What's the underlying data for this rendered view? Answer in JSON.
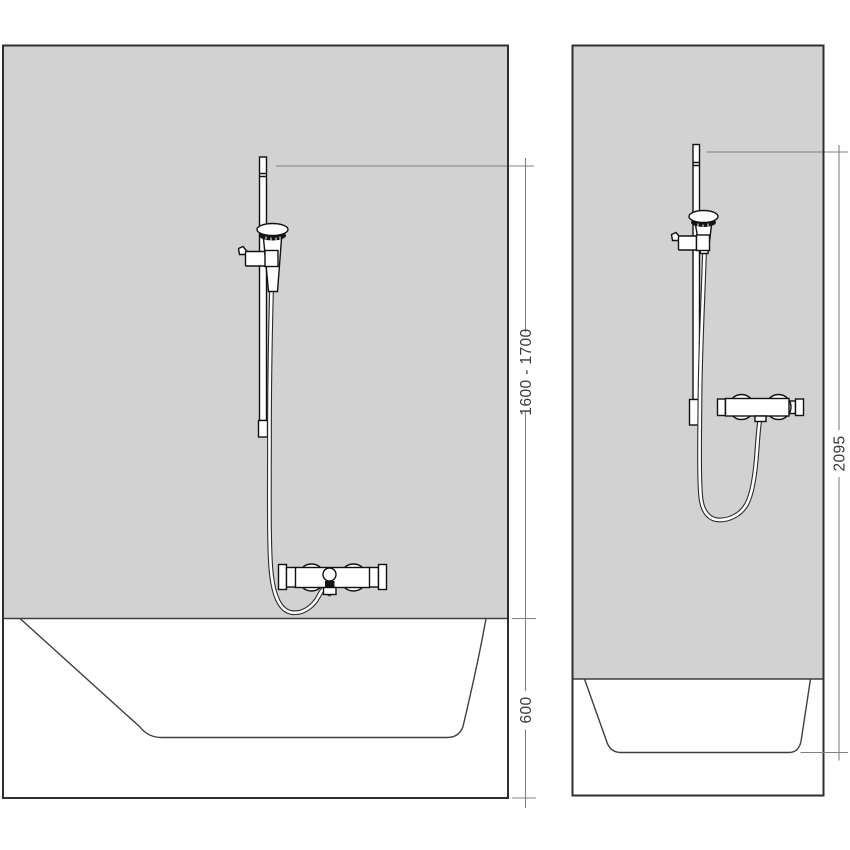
{
  "diagram": {
    "title": "shower-installation-dimension-drawing",
    "panels": {
      "bathtub": {
        "dimensions": {
          "bar_height_range": "1600 - 1700",
          "tub_height": "600"
        }
      },
      "shower": {
        "dimensions": {
          "total_height": "2095"
        }
      }
    },
    "colors": {
      "wall_fill": "#d2d2d2",
      "panel_border": "#2f2f2f",
      "outline": "#3f3f3f",
      "dimension_line": "#808080",
      "fixture_line": "#111111",
      "dimension_text": "#3a3a3a",
      "background": "#ffffff"
    }
  }
}
